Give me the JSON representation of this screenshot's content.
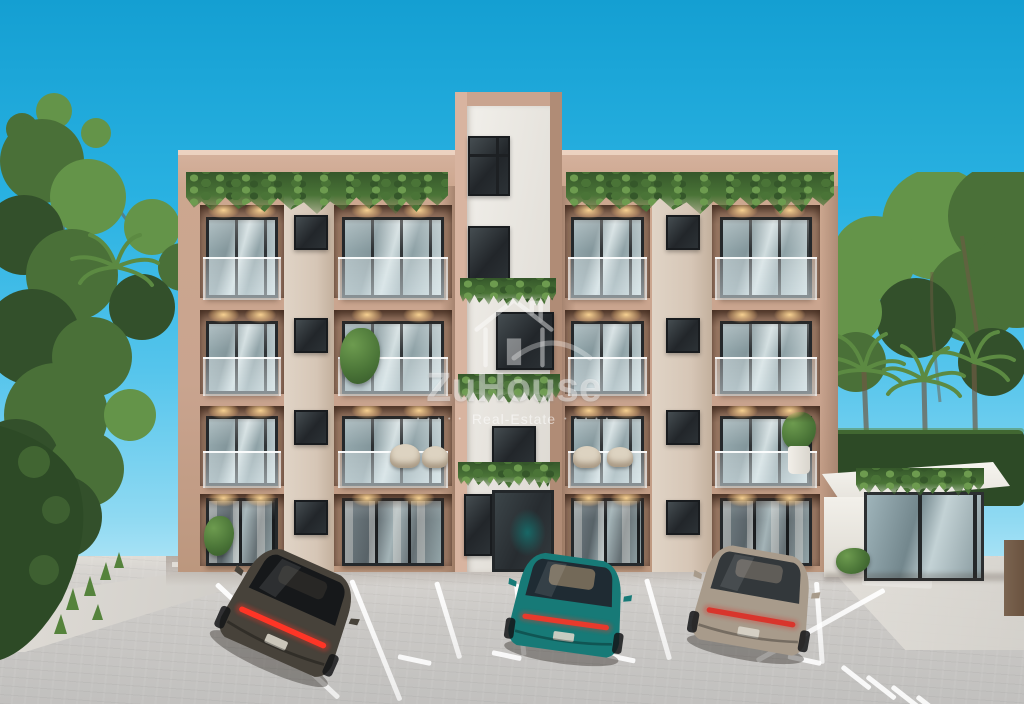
{
  "scene": {
    "description": "3D architectural rendering of a four-story beige apartment building with glass balconies, hanging roof greenery, a central white tower, landscaped trees, a white gatehouse and a paved parking lot with three parked sedans",
    "time_of_day": "day",
    "sky": "clear blue"
  },
  "watermark": {
    "brand": "ZuHouse",
    "tagline": "Real-Estate",
    "dots_left": "• • • • •",
    "dots_right": "• • • • •"
  },
  "building": {
    "floors": 4,
    "balcony_rows": 3,
    "ground_floor": "glass sliding doors",
    "roof_greenery": true,
    "central_tower": true
  },
  "cars": [
    {
      "name": "dark sports sedan",
      "colors": {
        "body": "#47423a",
        "glass": "#16181a",
        "tail": "#ff3526",
        "accent": "#3a362f"
      }
    },
    {
      "name": "teal sedan",
      "colors": {
        "body": "#177a77",
        "glass": "#1f2b33",
        "tail": "#e83a2c",
        "accent": "#c8a87e"
      }
    },
    {
      "name": "champagne sedan",
      "colors": {
        "body": "#a89b8b",
        "glass": "#33383b",
        "tail": "#d8352c",
        "accent": "#8d8276"
      }
    }
  ],
  "palette": {
    "skyTop": "#149fd2",
    "skyMid": "#2ab2e2",
    "skyLow": "#8ed9f2",
    "beige": "#c9a48f",
    "beigeLight": "#dcbba7",
    "beigeDark": "#a98670",
    "pier": "#e0d4c6",
    "white": "#edebe6",
    "whiteShade": "#d9d5cf",
    "frame": "#24282b",
    "glassA": "#93a8ad",
    "glassB": "#cfdcde",
    "vine": "#4a7437",
    "vineDark": "#35572a",
    "vineLight": "#6d9b4f",
    "warm": "#ffd9a0",
    "pave": "#cbc9c6",
    "paveLight": "#e0ddd7",
    "stripe": "#f7f6f3",
    "hedge": "#2d4a26",
    "grass": "#55833c",
    "tree1": "#33502b",
    "tree2": "#4a7038",
    "tree3": "#649449",
    "palm": "#5c8a42",
    "trunk": "#6e5a44",
    "gatehouse": "#f2f0ea",
    "post": "#6b5340"
  }
}
